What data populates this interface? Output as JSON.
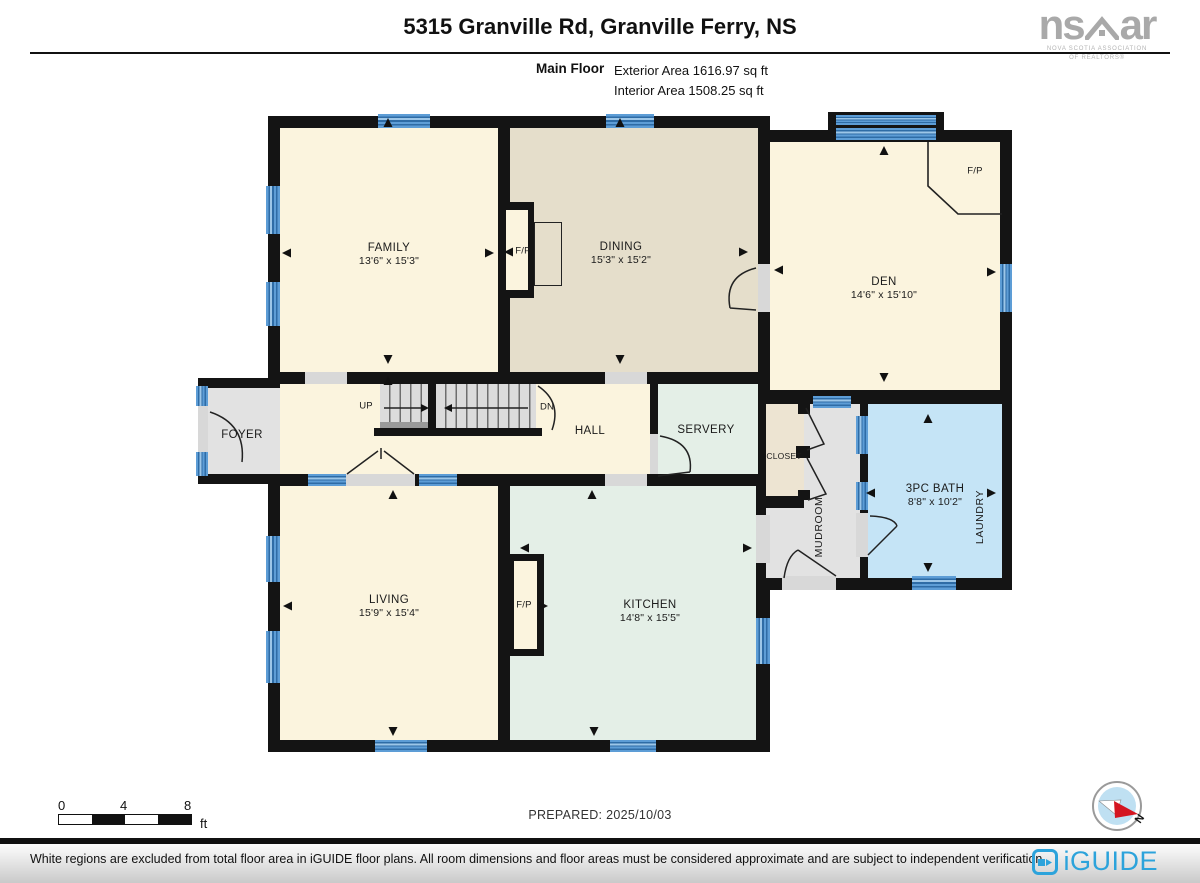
{
  "header": {
    "title": "5315 Granville Rd, Granville Ferry, NS",
    "floor_label": "Main Floor",
    "exterior_area": "Exterior Area 1616.97 sq ft",
    "interior_area": "Interior Area 1508.25 sq ft"
  },
  "nsar": {
    "ns": "ns",
    "ar": "ar",
    "tagline1": "NOVA SCOTIA ASSOCIATION",
    "tagline2": "OF REALTORS®"
  },
  "rooms": {
    "family": {
      "name": "FAMILY",
      "dims": "13'6\" x 15'3\""
    },
    "dining": {
      "name": "DINING",
      "dims": "15'3\" x 15'2\""
    },
    "den": {
      "name": "DEN",
      "dims": "14'6\" x 15'10\""
    },
    "living": {
      "name": "LIVING",
      "dims": "15'9\" x 15'4\""
    },
    "kitchen": {
      "name": "KITCHEN",
      "dims": "14'8\" x 15'5\""
    },
    "bath": {
      "name": "3PC BATH",
      "dims": "8'8\" x 10'2\""
    },
    "hall": {
      "name": "HALL"
    },
    "servery": {
      "name": "SERVERY"
    },
    "foyer": {
      "name": "FOYER"
    },
    "closet": {
      "name": "CLOSET"
    },
    "mudroom": {
      "name": "MUDROOM"
    },
    "laundry": {
      "name": "LAUNDRY"
    }
  },
  "annotations": {
    "fireplace": "F/P",
    "stairs_up": "UP",
    "stairs_down": "DN"
  },
  "scale_bar": {
    "ticks": [
      "0",
      "4",
      "8"
    ],
    "unit": "ft"
  },
  "prepared": "PREPARED: 2025/10/03",
  "compass": {
    "north": "N"
  },
  "footer": {
    "disclaimer": "White regions are excluded from total floor area in iGUIDE floor plans. All room dimensions and floor areas must be considered approximate and are subject to independent verification.",
    "brand": "iGUIDE"
  },
  "colors": {
    "wall": "#141414",
    "room_cream": "#FBF4DE",
    "room_tan": "#E5DECB",
    "room_mint": "#E4EFE7",
    "room_blue": "#C5E4F6",
    "room_gray": "#E2E2E2",
    "closet_tan": "#EDE4D2",
    "window_blue": "#5D9DD6",
    "iguide_blue": "#2CA3DB",
    "nsar_gray": "#A9A9A9"
  }
}
